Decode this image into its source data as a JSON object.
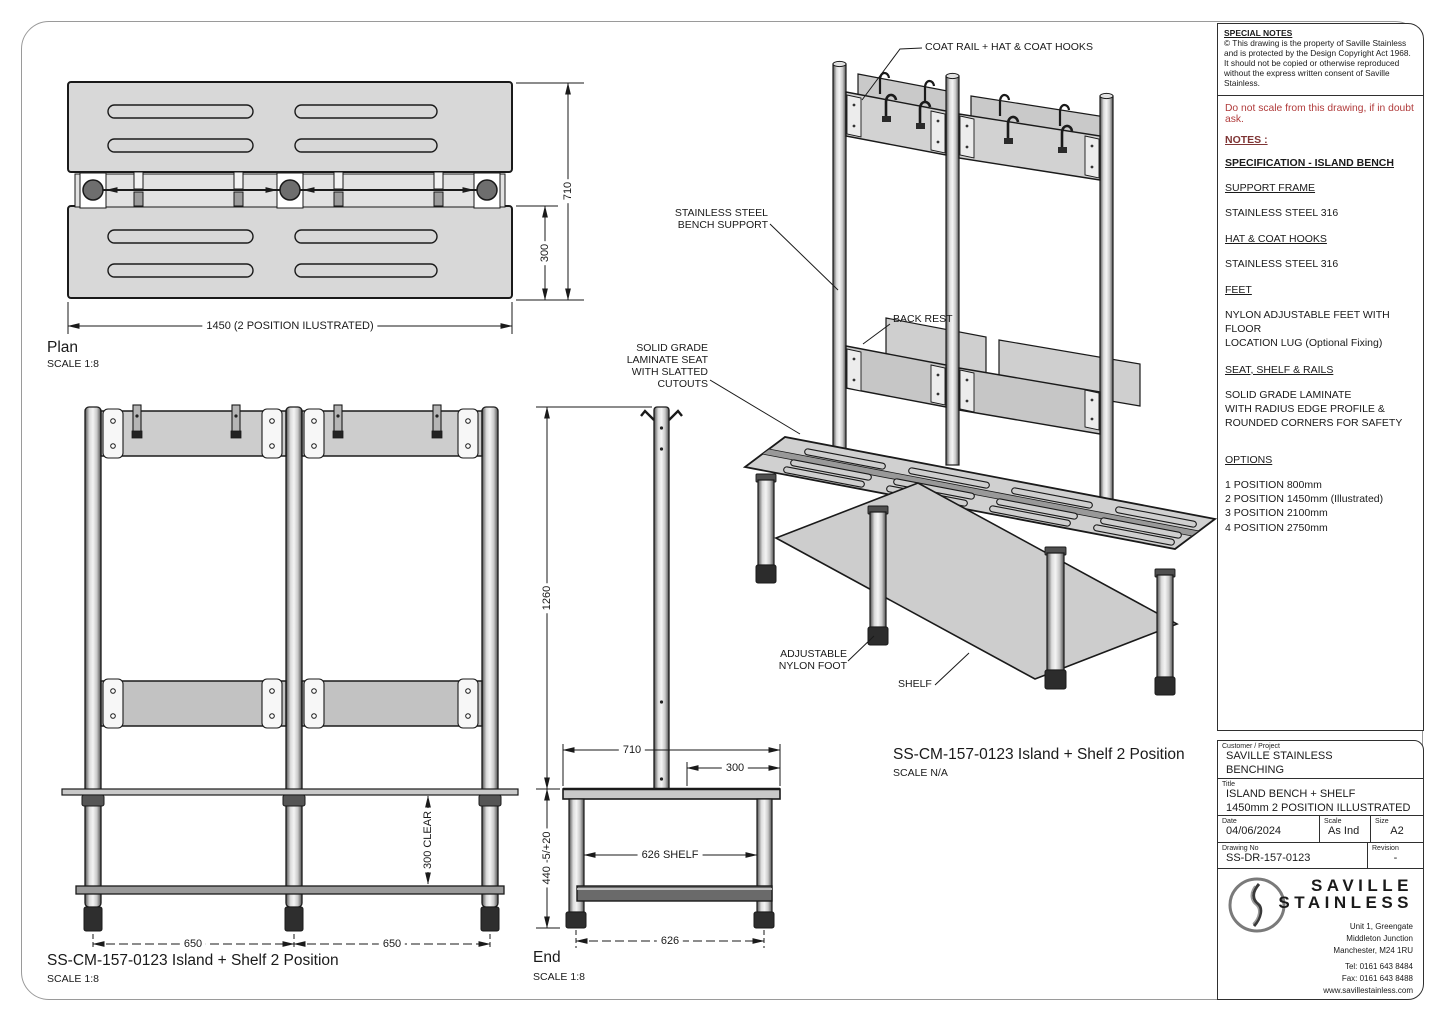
{
  "colors": {
    "line": "#1a1a1a",
    "slab_gray": "#d8d8d8",
    "panel_gray": "#cdcdcd",
    "foot_black": "#2e2e2e",
    "warning_red": "#b03a3a",
    "frame_gray": "#9a9a9a"
  },
  "special_notes": {
    "heading": "SPECIAL NOTES",
    "body": "© This drawing is the property of  Saville Stainless and is protected by the Design Copyright Act 1968.\nIt should not be copied or otherwise reproduced without the express written consent of Saville Stainless."
  },
  "notes": {
    "warning": "Do not scale from this drawing, if in doubt ask.",
    "heading": "NOTES :",
    "spec_heading": "SPECIFICATION - ISLAND BENCH",
    "sections": [
      {
        "heading": "SUPPORT FRAME",
        "body": "STAINLESS STEEL 316"
      },
      {
        "heading": "HAT & COAT HOOKS",
        "body": "STAINLESS STEEL 316"
      },
      {
        "heading": "FEET",
        "body": "NYLON ADJUSTABLE FEET WITH FLOOR\nLOCATION LUG (Optional Fixing)"
      },
      {
        "heading": "SEAT, SHELF & RAILS",
        "body": "SOLID GRADE LAMINATE\nWITH RADIUS EDGE PROFILE &\nROUNDED CORNERS FOR SAFETY"
      },
      {
        "heading": "OPTIONS",
        "body": "1 POSITION 800mm\n2 POSITION 1450mm (Illustrated)\n3 POSITION 2100mm\n4 POSITION 2750mm"
      }
    ]
  },
  "plan_view": {
    "title": "Plan",
    "scale": "SCALE 1:8",
    "dims": {
      "width": "1450  (2 POSITION ILUSTRATED)",
      "depth": "710",
      "seat": "300"
    }
  },
  "front_view": {
    "title": "SS-CM-157-0123 Island + Shelf 2 Position",
    "scale": "SCALE 1:8",
    "dims": {
      "bay_left": "650",
      "bay_right": "650",
      "clear": "300 CLEAR"
    }
  },
  "end_view": {
    "title": "End",
    "scale": "SCALE 1:8",
    "dims": {
      "above_seat": "1260",
      "depth": "710",
      "seat": "300",
      "shelf": "626 SHELF",
      "seat_height": "440 -5/+20",
      "width": "626"
    }
  },
  "iso_view": {
    "title": "SS-CM-157-0123 Island + Shelf 2 Position",
    "scale": "SCALE N/A",
    "labels": {
      "coat_rail": "COAT RAIL + HAT & COAT HOOKS",
      "bench_support": "STAINLESS STEEL\nBENCH SUPPORT",
      "back_rest": "BACK REST",
      "seat": "SOLID GRADE\nLAMINATE SEAT\nWITH SLATTED CUTOUTS",
      "foot": "ADJUSTABLE\nNYLON FOOT",
      "shelf": "SHELF"
    }
  },
  "title_block": {
    "customer_label": "Customer / Project",
    "customer_line1": "SAVILLE STAINLESS",
    "customer_line2": "BENCHING",
    "title_label": "Title",
    "title_line1": "ISLAND BENCH + SHELF",
    "title_line2": "1450mm 2 POSITION ILLUSTRATED",
    "date_label": "Date",
    "date": "04/06/2024",
    "scale_label": "Scale",
    "scale": "As Ind",
    "size_label": "Size",
    "size": "A2",
    "drawing_no_label": "Drawing No",
    "drawing_no": "SS-DR-157-0123",
    "revision_label": "Revision",
    "revision": "-",
    "brand_line1": "SAVILLE",
    "brand_line2": "STAINLESS",
    "address_line1": "Unit 1, Greengate",
    "address_line2": "Middleton Junction",
    "address_line3": "Manchester, M24 1RU",
    "tel": "Tel:  0161 643 8484",
    "fax": "Fax:  0161 643 8488",
    "web": "www.savillestainless.com"
  }
}
